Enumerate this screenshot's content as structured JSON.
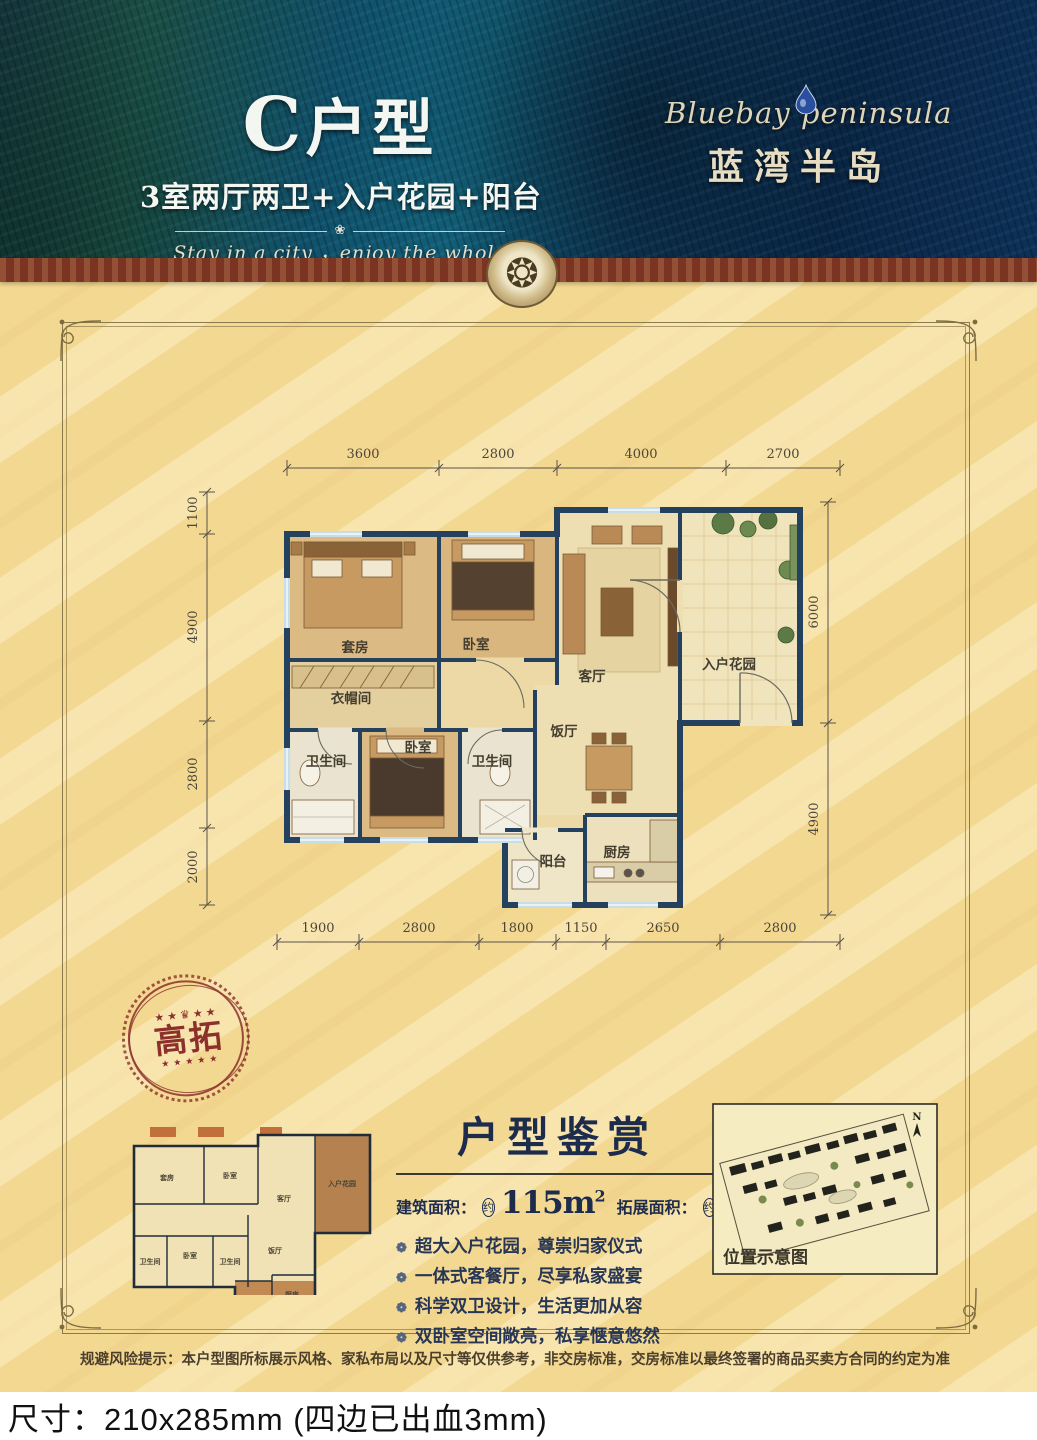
{
  "header": {
    "unit_title_letter": "C",
    "unit_title_rest": "户型",
    "unit_subtitle": "3室两厅两卫+入户花园+阳台",
    "divider_ornament": "❀",
    "tagline": "Stay in a city ，enjoy the whole world",
    "brand_en": "Bluebay peninsula",
    "brand_cn": "蓝湾半岛",
    "medallion_glyph": "❂",
    "colors": {
      "feather_teal": "#126079",
      "feather_navy": "#0a2646",
      "band_maroon": "#7b3421",
      "body_yellow": "#f3d892"
    }
  },
  "floor_plan": {
    "dims_top": [
      "3600",
      "2800",
      "4000",
      "2700"
    ],
    "dims_left": [
      "1100",
      "4900",
      "2800",
      "2000"
    ],
    "dims_right": [
      "6000",
      "4900"
    ],
    "dims_bottom": [
      "1900",
      "2800",
      "1800",
      "1150",
      "2650",
      "2800"
    ],
    "rooms": {
      "suite": "套房",
      "wardrobe": "衣帽间",
      "bedroom2": "卧室",
      "living": "客厅",
      "garden": "入户花园",
      "dining": "饭厅",
      "bath1": "卫生间",
      "bedroom3": "卧室",
      "bath2": "卫生间",
      "balcony": "阳台",
      "kitchen": "厨房"
    }
  },
  "stamp": {
    "label": "高拓",
    "crown": "♛",
    "stars_top_left": "★★",
    "stars_top_right": "★★",
    "stars_bottom": "★★★★★",
    "color": "#8b302b"
  },
  "appreciation": {
    "title": "户型鉴赏",
    "build_label": "建筑面积：",
    "approx": "约",
    "build_value": "115m",
    "build_sup": "2",
    "ext_label": "拓展面积：",
    "ext_value": "13m",
    "ext_sup": "2",
    "bullet_icon": "❁",
    "bullets": [
      "超大入户花园，尊崇归家仪式",
      "一体式客餐厅，尽享私家盛宴",
      "科学双卫设计，生活更加从容",
      "双卧室空间敞亮，私享惬意悠然"
    ]
  },
  "location_map": {
    "caption": "位置示意图",
    "north_label": "N"
  },
  "disclaimer": "规避风险提示：本户型图所标展示风格、家私布局以及尺寸等仅供参考，非交房标准，交房标准以最终签署的商品买卖方合同的约定为准",
  "print_note": "尺寸：210x285mm (四边已出血3mm)"
}
